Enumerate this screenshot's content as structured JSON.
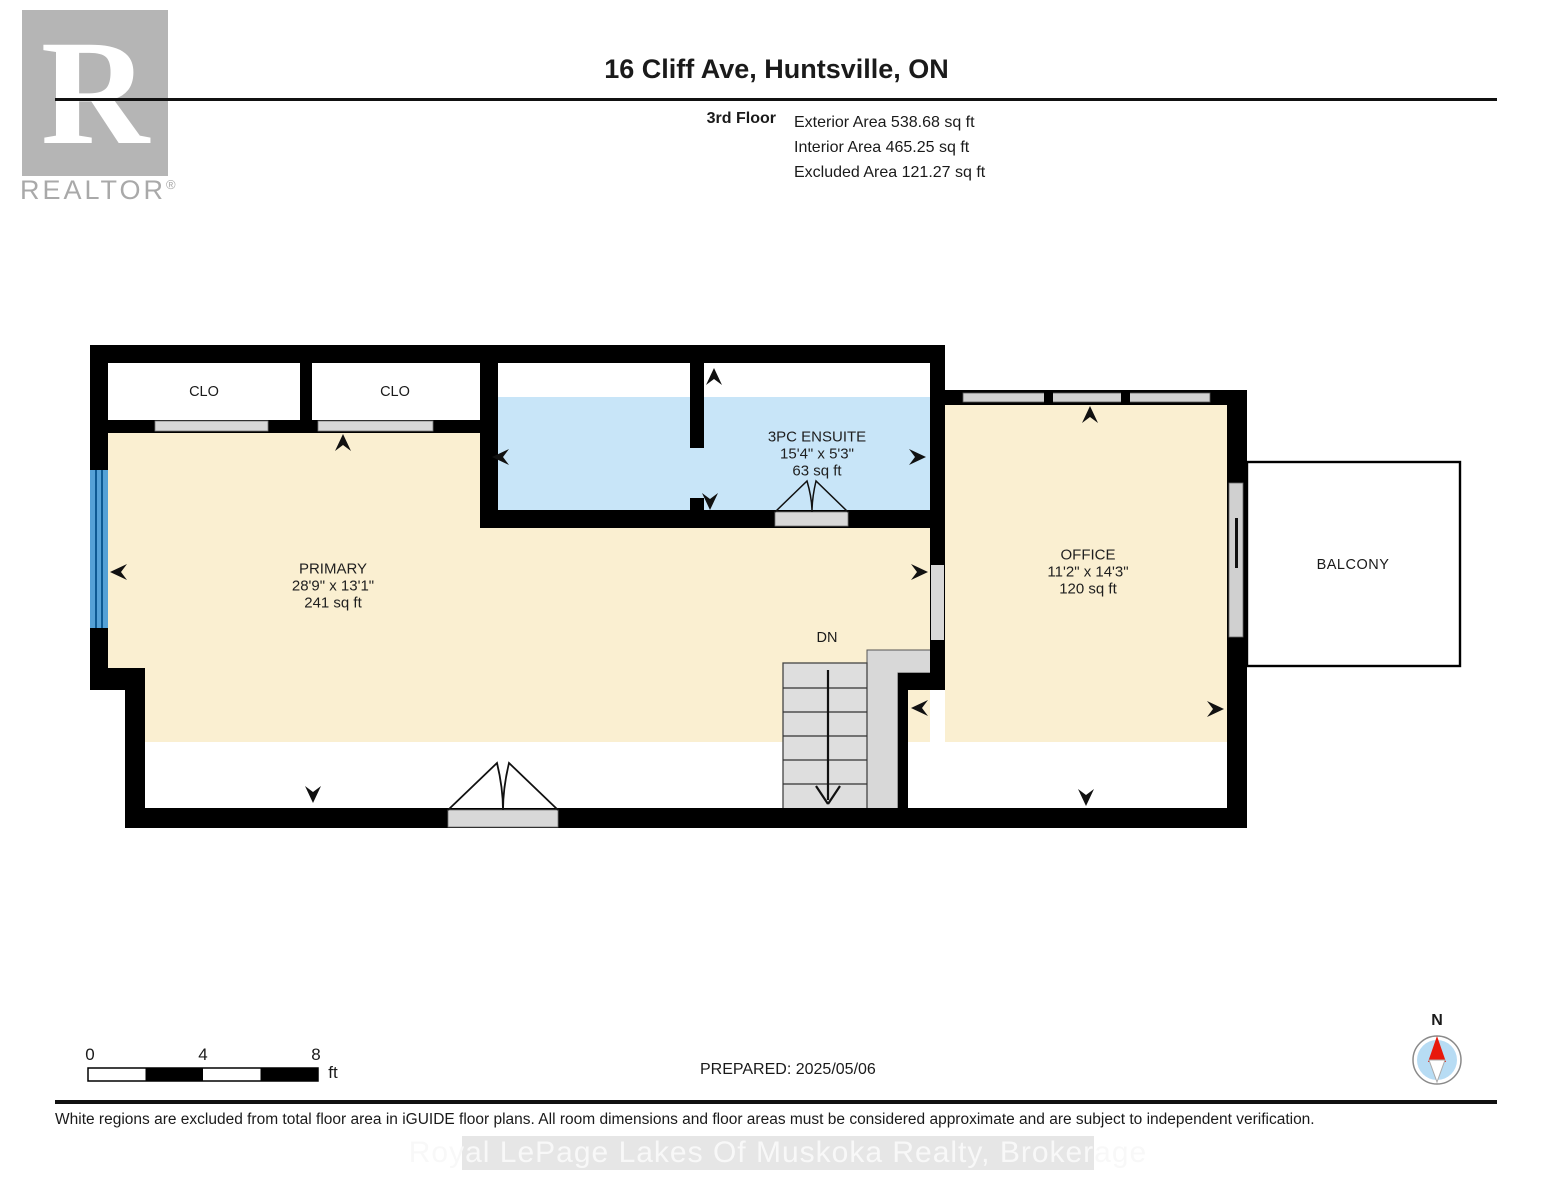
{
  "header": {
    "logo": {
      "monogram": "R",
      "brand": "REALTOR",
      "registered": "®"
    },
    "title": "16 Cliff Ave, Huntsville, ON",
    "floor_label": "3rd Floor",
    "area_lines": [
      "Exterior Area 538.68 sq ft",
      "Interior Area 465.25 sq ft",
      "Excluded Area 121.27 sq ft"
    ]
  },
  "plan": {
    "closets": [
      {
        "label": "CLO"
      },
      {
        "label": "CLO"
      }
    ],
    "primary": {
      "name": "PRIMARY",
      "dims": "28'9\" x 13'1\"",
      "area": "241 sq ft"
    },
    "ensuite": {
      "name": "3PC ENSUITE",
      "dims": "15'4\" x 5'3\"",
      "area": "63 sq ft"
    },
    "office": {
      "name": "OFFICE",
      "dims": "11'2\" x 14'3\"",
      "area": "120 sq ft"
    },
    "balcony_label": "BALCONY",
    "stairs_label": "DN",
    "colors": {
      "interior": "#FAEFD1",
      "ensuite": "#C8E5F8",
      "excluded": "#FFFFFF",
      "wall": "#000000",
      "window_blue": "#55A1D6",
      "door_gray": "#D8D8D8",
      "stairs_gray": "#DEDEDE"
    }
  },
  "scale_bar": {
    "ticks": [
      "0",
      "4",
      "8"
    ],
    "unit": "ft"
  },
  "compass": {
    "north": "N",
    "needle_red": "#E8190C",
    "disc_blue": "#B7DCF4"
  },
  "prepared_label": "PREPARED: 2025/05/06",
  "footer": {
    "disclaimer": "White regions are excluded from total floor area in iGUIDE floor plans. All room dimensions and floor areas must be considered approximate and are subject to independent verification."
  },
  "watermark": "Royal LePage Lakes Of Muskoka Realty, Brokerage"
}
